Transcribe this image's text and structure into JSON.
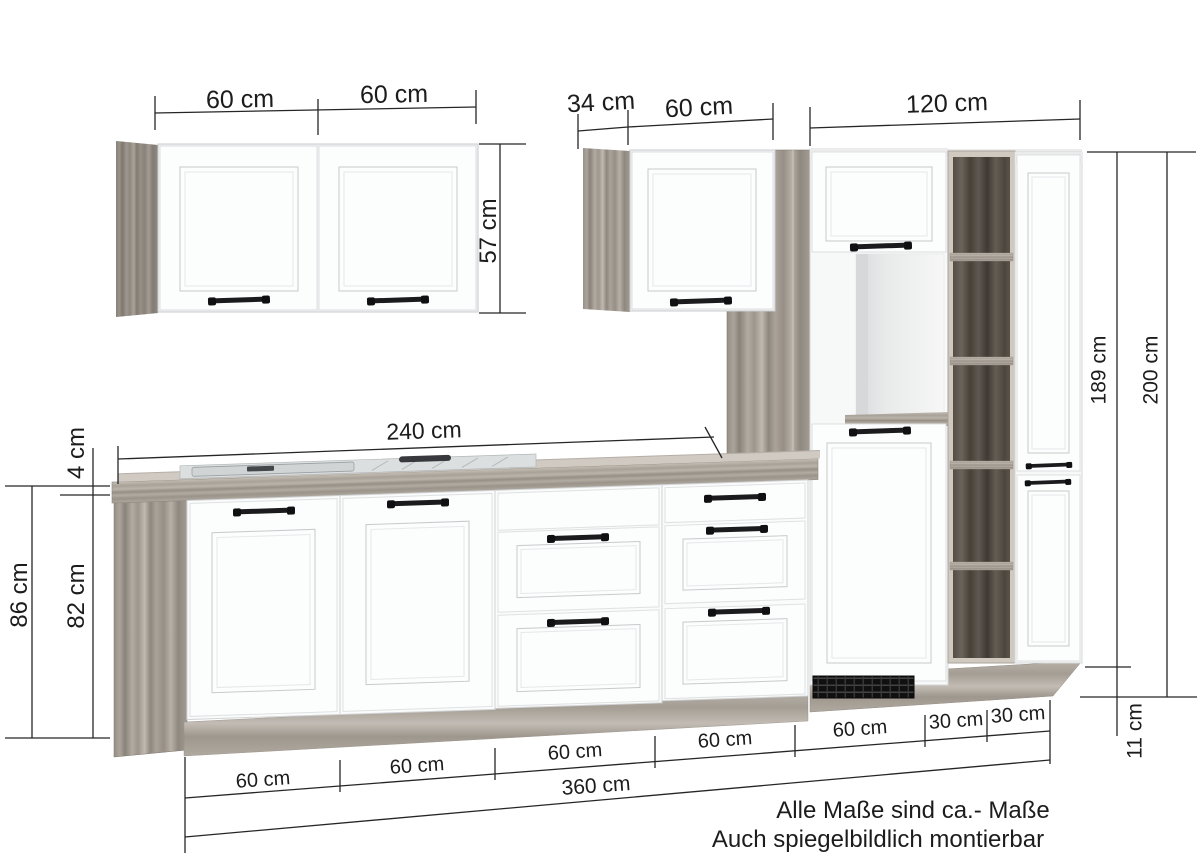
{
  "title": "Kitchen unit dimension diagram",
  "colors": {
    "background": "#ffffff",
    "front_white": "#fbfcfd",
    "wood_light": "#a9a29a",
    "wood_dark": "#554f48",
    "steel": "#d6d9da",
    "line": "#262626"
  },
  "diagram": {
    "wall_section": {
      "door1": "60 cm",
      "door2": "60 cm",
      "height": "57 cm",
      "mid_depth": "34 cm",
      "mid_width": "60 cm"
    },
    "tall_section": {
      "width": "120 cm",
      "height_unit": "189 cm",
      "height_total": "200 cm",
      "plinth": "11 cm"
    },
    "base_section": {
      "run": "240 cm",
      "worktop": "4 cm",
      "height_total": "86 cm",
      "height_unit": "82 cm"
    },
    "bottom": {
      "segments": [
        "60 cm",
        "60 cm",
        "60 cm",
        "60 cm",
        "60 cm",
        "30 cm",
        "30 cm"
      ],
      "total": "360 cm"
    },
    "notes": [
      "Alle Maße sind ca.- Maße",
      "Auch spiegelbildlich montierbar"
    ]
  }
}
